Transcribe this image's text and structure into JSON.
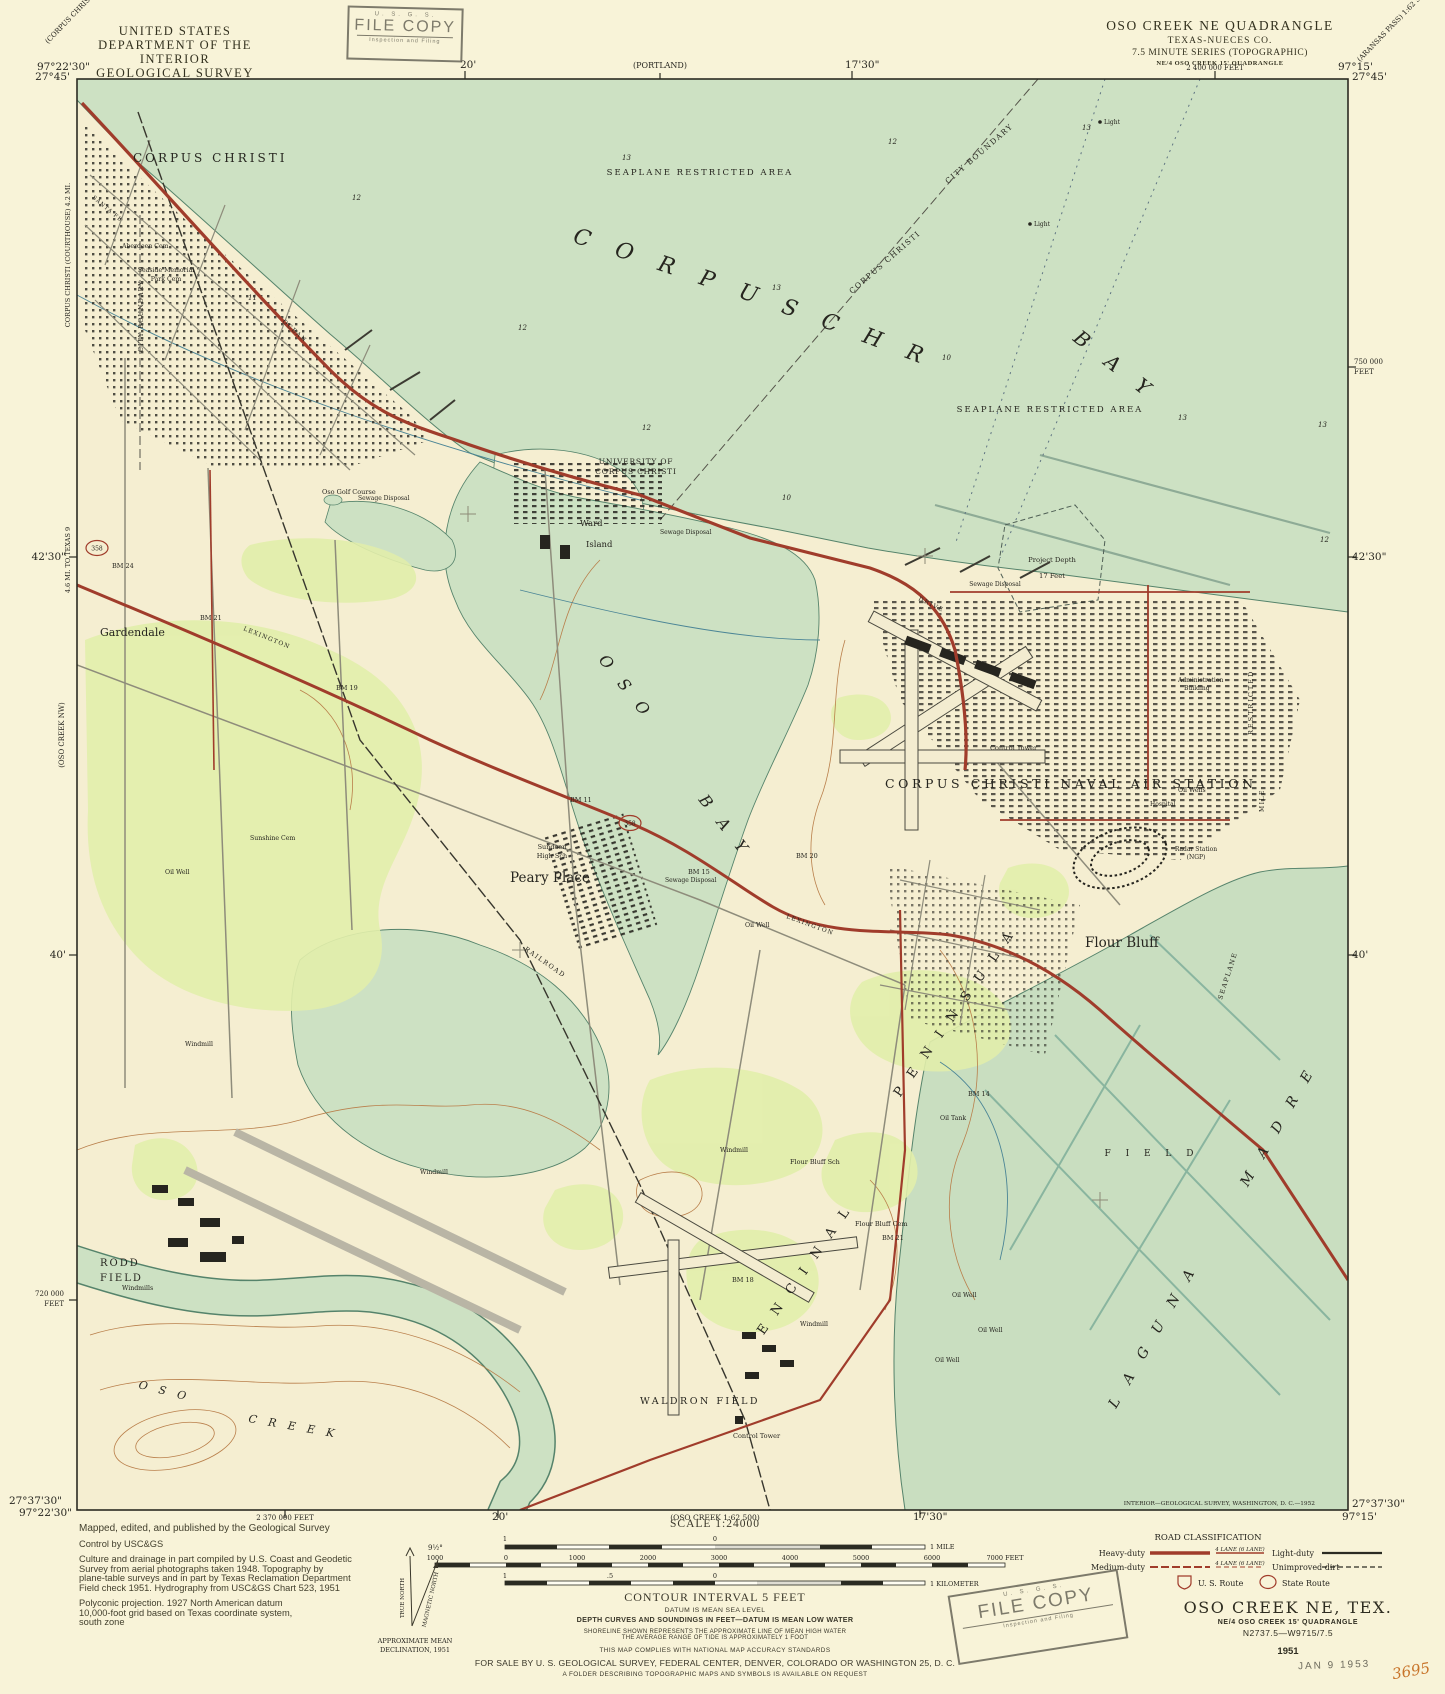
{
  "header": {
    "agency_line1": "UNITED STATES",
    "agency_line2": "DEPARTMENT OF THE INTERIOR",
    "agency_line3": "GEOLOGICAL SURVEY",
    "quad_title": "OSO CREEK NE QUADRANGLE",
    "quad_state": "TEXAS-NUECES CO.",
    "quad_series": "7.5 MINUTE SERIES (TOPOGRAPHIC)",
    "quad_sub": "NE/4 OSO CREEK 15' QUADRANGLE"
  },
  "stamps": {
    "usgs": "U. S. G. S.",
    "file_copy": "FILE COPY",
    "file_copy_sub": "Inspection and Filing",
    "date_stamp": "JAN 9 1953",
    "handwritten_number": "3695"
  },
  "collar": {
    "top_left_lon": "97°22'30\"",
    "top_left_lat": "27°45'",
    "top_right_lon": "97°15'",
    "top_right_lat": "27°45'",
    "bottom_left_lat": "27°37'30\"",
    "bottom_left_lon": "97°22'30\"",
    "bottom_right_lat": "27°37'30\"",
    "bottom_right_lon": "97°15'",
    "top_tick_20": "20'",
    "adjoining_top": "(PORTLAND)",
    "top_tick_1730": "17'30\"",
    "top_feet": "2 400 000 FEET",
    "bottom_feet": "2 370 000 FEET",
    "bottom_tick_20": "20'",
    "adjoining_bottom": "(OSO CREEK 1:62 500)",
    "bottom_tick_1730": "17'30\"",
    "left_tick_4230": "42'30\"",
    "left_tick_40": "40'",
    "left_feet_1": "720 000",
    "left_feet_2": "FEET",
    "right_feet_1": "750 000",
    "right_feet_2": "FEET",
    "right_tick_4230": "42'30\"",
    "right_tick_40": "40'",
    "corner_nw": "(CORPUS CHRISTI) 1:62 500",
    "corner_ne": "(ARANSAS PASS) 1:62 500",
    "margin_note_courthouse": "CORPUS CHRISTI (COURTHOUSE) 4.2 MI.",
    "margin_note_texas": "4.6 MI. TO TEXAS 9",
    "adjoining_west": "(OSO CREEK NW)",
    "imprint": "INTERIOR—GEOLOGICAL SURVEY, WASHINGTON, D. C.—1952"
  },
  "map": {
    "labels": {
      "city": "CORPUS CHRISTI",
      "seaplane_restricted": "SEAPLANE      RESTRICTED      AREA",
      "bay_name": "C O R P U S    C H R I S T I",
      "bay_word": "B A Y",
      "city_boundary": "CITY BOUNDARY",
      "boundary_owner": "CORPUS CHRISTI",
      "university1": "UNIVERSITY OF",
      "university2": "CORPUS CHRISTI",
      "ward1": "Ward",
      "ward2": "Island",
      "sewage": "Sewage Disposal",
      "project_depth1": "Project Depth",
      "project_depth2": "17 Feet",
      "light": "Light",
      "nas": "CORPUS CHRISTI NAVAL AIR STATION",
      "control_tower": "Control Tower",
      "admin1": "Administration",
      "admin2": "Building",
      "hospital": "Hospital",
      "radar1": "Radar Station",
      "radar2": "(NGP)",
      "gardendale": "Gardendale",
      "peary": "Peary Place",
      "sundeen1": "Sundeen",
      "sundeen2": "High Sch",
      "flour_bluff": "Flour Bluff",
      "oso": "O S O",
      "bay2": "B A Y",
      "encinal": "E N C I N A L",
      "peninsula": "P E N I N S U L A",
      "laguna": "L A G U N A",
      "madre": "M A D R E",
      "field": "F I E L D",
      "rodd1": "RODD",
      "rodd2": "FIELD",
      "waldron": "WALDRON  FIELD",
      "creek_oso": "O S O",
      "creek": "C R E E K",
      "aberdeen": "Aberdeen Cem",
      "seaside1": "Seaside  Memorial",
      "seaside2": "Park Cem",
      "sunshine": "Sunshine Cem",
      "golf": "Oso Golf Course",
      "oil_well": "Oil Well",
      "oil_wells": "Oil Wells",
      "oil_tank": "Oil Tank",
      "windmill": "Windmill",
      "windmills": "Windmills",
      "fb_sch": "Flour Bluff Sch",
      "fb_cem": "Flour Bluff Cem",
      "restricted": "RESTRICTED",
      "mile_v": "MILE",
      "seaplane_v": "SEAPLANE",
      "ocean": "OCEAN",
      "drive": "DRIVE",
      "lexington": "LEXINGTON",
      "railroad": "RAILROAD",
      "santa_fe": "SANTA FE",
      "shield": "358",
      "bm24": "BM 24",
      "bm21": "BM 21",
      "bm19": "BM 19",
      "bm15": "BM 15",
      "bm20": "BM 20",
      "bm14": "BM 14",
      "bm11": "BM 11",
      "bm18": "BM 18"
    },
    "depths": [
      "12",
      "13",
      "12",
      "13",
      "11",
      "12",
      "13",
      "10",
      "13",
      "12",
      "10",
      "13",
      "12"
    ]
  },
  "footer": {
    "credit1": "Mapped, edited, and published by the Geological Survey",
    "credit2": "Control by USC&GS",
    "credit3a": "Culture and drainage in part compiled by U.S. Coast and Geodetic",
    "credit3b": "Survey from aerial photographs taken 1948. Topography by",
    "credit3c": "plane-table surveys and in part by Texas Reclamation Department",
    "credit3d": "Field check 1951. Hydrography from USC&GS Chart 523, 1951",
    "credit4a": "Polyconic projection. 1927 North American datum",
    "credit4b": "10,000-foot grid based on Texas coordinate system,",
    "credit4c": "south zone",
    "declination_angle": "9½°",
    "true_north": "TRUE NORTH",
    "magnetic_north": "MAGNETIC NORTH",
    "declination_caption1": "APPROXIMATE MEAN",
    "declination_caption2": "DECLINATION, 1951",
    "scale": "SCALE 1:24000",
    "mile_left": "1",
    "mile_zero": "0",
    "mile_right": "1 MILE",
    "feet_ticks": [
      "1000",
      "0",
      "1000",
      "2000",
      "3000",
      "4000",
      "5000",
      "6000",
      "7000 FEET"
    ],
    "km_left": "1",
    "km_half": ".5",
    "km_zero": "0",
    "km_right": "1 KILOMETER",
    "contour": "CONTOUR INTERVAL 5 FEET",
    "datum": "DATUM IS MEAN SEA LEVEL",
    "depth_note": "DEPTH CURVES AND SOUNDINGS IN FEET—DATUM IS MEAN LOW WATER",
    "shoreline1": "SHORELINE SHOWN REPRESENTS THE APPROXIMATE LINE OF MEAN HIGH WATER",
    "shoreline2": "THE AVERAGE RANGE OF TIDE IS APPROXIMATELY 1 FOOT",
    "accuracy": "THIS MAP COMPLIES WITH NATIONAL MAP ACCURACY STANDARDS",
    "sale": "FOR SALE BY U. S. GEOLOGICAL SURVEY, FEDERAL CENTER, DENVER, COLORADO OR WASHINGTON 25, D. C.",
    "folder": "A FOLDER DESCRIBING TOPOGRAPHIC MAPS AND SYMBOLS IS AVAILABLE ON REQUEST",
    "road_class_title": "ROAD CLASSIFICATION",
    "heavy": "Heavy-duty",
    "medium": "Medium-duty",
    "light": "Light-duty",
    "unimproved": "Unimproved dirt",
    "lane_note": "4 LANE (6 LANE)",
    "us_route": "U. S. Route",
    "state_route": "State Route",
    "title": "OSO CREEK NE, TEX.",
    "title_sub": "NE/4 OSO CREEK 15' QUADRANGLE",
    "title_code": "N2737.5—W9715/7.5",
    "title_year": "1951"
  },
  "colors": {
    "paper": "#f8f3d8",
    "water": "#cde1c3",
    "woodland": "#e2eeab",
    "road_red": "#a03c2b",
    "contour_brown": "#b97f4b",
    "depth_blue": "#2f7796"
  }
}
